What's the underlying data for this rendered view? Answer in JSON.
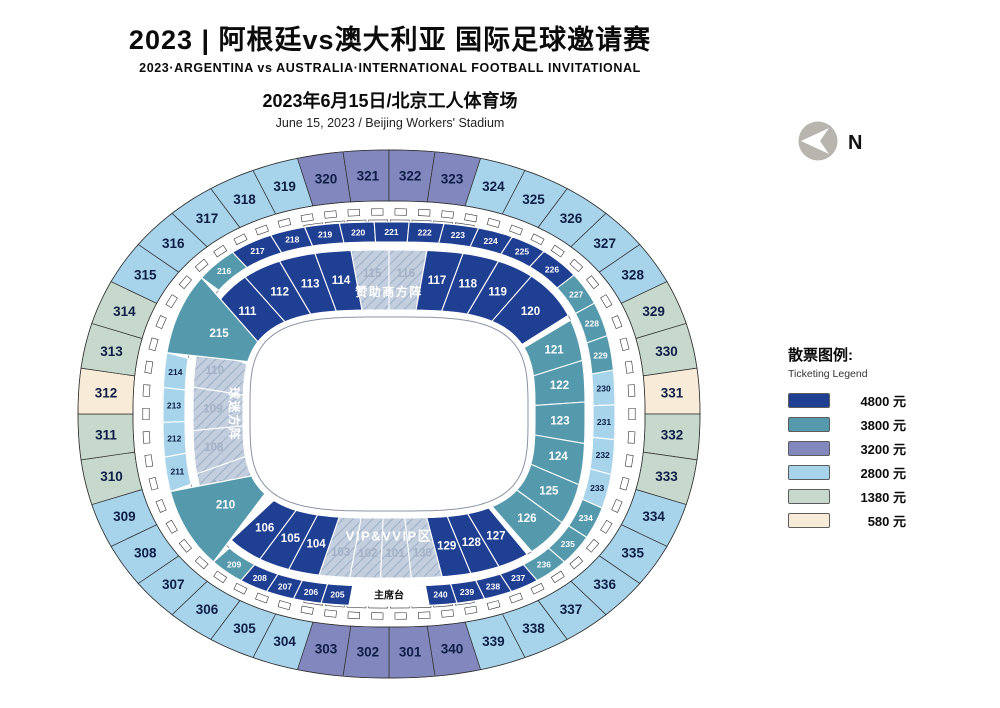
{
  "header": {
    "title_cn": "2023 | 阿根廷vs澳大利亚 国际足球邀请赛",
    "title_en": "2023·ARGENTINA vs AUSTRALIA·INTERNATIONAL FOOTBALL INVITATIONAL",
    "date_cn": "2023年6月15日/北京工人体育场",
    "date_en": "June 15, 2023 / Beijing Workers' Stadium"
  },
  "compass": {
    "label": "N"
  },
  "legend": {
    "title_cn": "散票图例:",
    "title_en": "Ticketing Legend",
    "items": [
      {
        "price": "4800 元",
        "tier": "4800",
        "color": "#1f3f92"
      },
      {
        "price": "3800 元",
        "tier": "3800",
        "color": "#5599ad"
      },
      {
        "price": "3200 元",
        "tier": "3200",
        "color": "#8287bd"
      },
      {
        "price": "2800 元",
        "tier": "2800",
        "color": "#a7d3eb"
      },
      {
        "price": "1380 元",
        "tier": "1380",
        "color": "#c7d8cc"
      },
      {
        "price": "580 元",
        "tier": "580",
        "color": "#f8ecd8"
      }
    ]
  },
  "map": {
    "stage_label": "主席台",
    "zone_labels": {
      "sponsor": "赞助商方阵",
      "vip": "VIP&VVIP区",
      "fans": "球迷方阵"
    },
    "tier_colors": {
      "4800": "#1f3f92",
      "3800": "#5599ad",
      "3200": "#8287bd",
      "2800": "#a7d3eb",
      "1380": "#c7d8cc",
      "580": "#f8ecd8"
    },
    "hatch_base": "#c3cfde",
    "hatch_line": "#9fb2c8",
    "ring_outer": [
      {
        "id": "316",
        "tier": "2800"
      },
      {
        "id": "317",
        "tier": "2800"
      },
      {
        "id": "318",
        "tier": "2800"
      },
      {
        "id": "319",
        "tier": "2800"
      },
      {
        "id": "320",
        "tier": "3200"
      },
      {
        "id": "321",
        "tier": "3200"
      },
      {
        "id": "322",
        "tier": "3200"
      },
      {
        "id": "323",
        "tier": "3200"
      },
      {
        "id": "324",
        "tier": "2800"
      },
      {
        "id": "325",
        "tier": "2800"
      },
      {
        "id": "326",
        "tier": "2800"
      },
      {
        "id": "327",
        "tier": "2800"
      },
      {
        "id": "328",
        "tier": "2800"
      },
      {
        "id": "329",
        "tier": "1380"
      },
      {
        "id": "330",
        "tier": "1380"
      },
      {
        "id": "331",
        "tier": "580"
      },
      {
        "id": "332",
        "tier": "1380"
      },
      {
        "id": "333",
        "tier": "1380"
      },
      {
        "id": "334",
        "tier": "2800"
      },
      {
        "id": "335",
        "tier": "2800"
      },
      {
        "id": "336",
        "tier": "2800"
      },
      {
        "id": "337",
        "tier": "2800"
      },
      {
        "id": "338",
        "tier": "2800"
      },
      {
        "id": "339",
        "tier": "2800"
      },
      {
        "id": "340",
        "tier": "3200"
      },
      {
        "id": "301",
        "tier": "3200"
      },
      {
        "id": "302",
        "tier": "3200"
      },
      {
        "id": "303",
        "tier": "3200"
      },
      {
        "id": "304",
        "tier": "2800"
      },
      {
        "id": "305",
        "tier": "2800"
      },
      {
        "id": "306",
        "tier": "2800"
      },
      {
        "id": "307",
        "tier": "2800"
      },
      {
        "id": "308",
        "tier": "2800"
      },
      {
        "id": "309",
        "tier": "2800"
      },
      {
        "id": "310",
        "tier": "1380"
      },
      {
        "id": "311",
        "tier": "1380"
      },
      {
        "id": "312",
        "tier": "580"
      },
      {
        "id": "313",
        "tier": "1380"
      },
      {
        "id": "314",
        "tier": "1380"
      },
      {
        "id": "315",
        "tier": "2800"
      }
    ],
    "ring_middle": [
      {
        "id": "217",
        "tier": "4800",
        "w": 1.2
      },
      {
        "id": "218",
        "tier": "4800"
      },
      {
        "id": "219",
        "tier": "4800"
      },
      {
        "id": "220",
        "tier": "4800"
      },
      {
        "id": "221",
        "tier": "4800"
      },
      {
        "id": "222",
        "tier": "4800"
      },
      {
        "id": "223",
        "tier": "4800"
      },
      {
        "id": "224",
        "tier": "4800"
      },
      {
        "id": "225",
        "tier": "4800"
      },
      {
        "id": "226",
        "tier": "4800",
        "w": 1.1
      },
      {
        "id": "227",
        "tier": "3800"
      },
      {
        "id": "228",
        "tier": "3800"
      },
      {
        "id": "229",
        "tier": "3800"
      },
      {
        "id": "230",
        "tier": "2800"
      },
      {
        "id": "231",
        "tier": "2800"
      },
      {
        "id": "232",
        "tier": "2800"
      },
      {
        "id": "233",
        "tier": "2800"
      },
      {
        "id": "234",
        "tier": "3800",
        "w": 0.95
      },
      {
        "id": "235",
        "tier": "3800",
        "w": 0.95
      },
      {
        "id": "236",
        "tier": "3800",
        "w": 0.95
      },
      {
        "id": "237",
        "tier": "4800",
        "w": 0.8
      },
      {
        "id": "238",
        "tier": "4800",
        "w": 0.8
      },
      {
        "id": "239",
        "tier": "4800",
        "w": 0.8
      },
      {
        "id": "240",
        "tier": "4800",
        "w": 0.8
      },
      {
        "type": "stage",
        "w": 2.3
      },
      {
        "id": "205",
        "tier": "4800",
        "w": 0.8
      },
      {
        "id": "206",
        "tier": "4800",
        "w": 0.8
      },
      {
        "id": "207",
        "tier": "4800",
        "w": 0.8
      },
      {
        "id": "208",
        "tier": "4800",
        "w": 0.8
      },
      {
        "id": "209",
        "tier": "3800",
        "w": 0.95
      },
      {
        "type": "gap",
        "ref": "210",
        "w": 2.4
      },
      {
        "id": "211",
        "tier": "2800"
      },
      {
        "id": "212",
        "tier": "2800"
      },
      {
        "id": "213",
        "tier": "2800"
      },
      {
        "id": "214",
        "tier": "2800"
      },
      {
        "type": "gap",
        "ref": "215",
        "w": 2.4
      },
      {
        "id": "216",
        "tier": "3800",
        "w": 1.15
      }
    ],
    "ring_inner": [
      {
        "id": "111",
        "tier": "4800",
        "w": 1.4
      },
      {
        "id": "112",
        "tier": "4800",
        "w": 1.05
      },
      {
        "id": "113",
        "tier": "4800"
      },
      {
        "id": "114",
        "tier": "4800"
      },
      {
        "id": "115",
        "tier": "hatch",
        "w": 1.05
      },
      {
        "id": "116",
        "tier": "hatch",
        "w": 1.05
      },
      {
        "id": "117",
        "tier": "4800"
      },
      {
        "id": "118",
        "tier": "4800"
      },
      {
        "id": "119",
        "tier": "4800"
      },
      {
        "id": "120",
        "tier": "4800",
        "w": 1.5
      },
      {
        "type": "gap",
        "w": 0.15
      },
      {
        "id": "121",
        "tier": "3800",
        "w": 1.16
      },
      {
        "id": "122",
        "tier": "3800",
        "w": 1.15
      },
      {
        "id": "123",
        "tier": "3800",
        "w": 1.15
      },
      {
        "id": "124",
        "tier": "3800",
        "w": 1.15
      },
      {
        "id": "125",
        "tier": "3800",
        "w": 1.15
      },
      {
        "id": "126",
        "tier": "3800",
        "w": 1.16
      },
      {
        "type": "gap",
        "w": 0.15
      },
      {
        "id": "127",
        "tier": "4800",
        "w": 0.85
      },
      {
        "id": "128",
        "tier": "4800",
        "w": 0.8
      },
      {
        "id": "129",
        "tier": "4800",
        "w": 0.8
      },
      {
        "id": "130",
        "tier": "hatch",
        "w": 0.85
      },
      {
        "id": "101",
        "tier": "hatch",
        "w": 0.85
      },
      {
        "id": "102",
        "tier": "hatch",
        "w": 0.85
      },
      {
        "id": "103",
        "tier": "hatch",
        "w": 0.85
      },
      {
        "id": "104",
        "tier": "4800",
        "w": 0.85
      },
      {
        "id": "105",
        "tier": "4800",
        "w": 0.85
      },
      {
        "id": "106",
        "tier": "4800",
        "w": 0.95
      },
      {
        "type": "gap",
        "w": 0.9
      },
      {
        "id": "107",
        "tier": "hatch",
        "w": 1.2
      },
      {
        "id": "108",
        "tier": "hatch",
        "w": 1.2
      },
      {
        "id": "109",
        "tier": "hatch",
        "w": 1.2
      },
      {
        "id": "110",
        "tier": "hatch",
        "w": 1.2
      },
      {
        "type": "gap",
        "w": 0.9
      }
    ],
    "wedges": [
      {
        "id": "210",
        "tier": "3800"
      },
      {
        "id": "215",
        "tier": "3800"
      }
    ]
  }
}
